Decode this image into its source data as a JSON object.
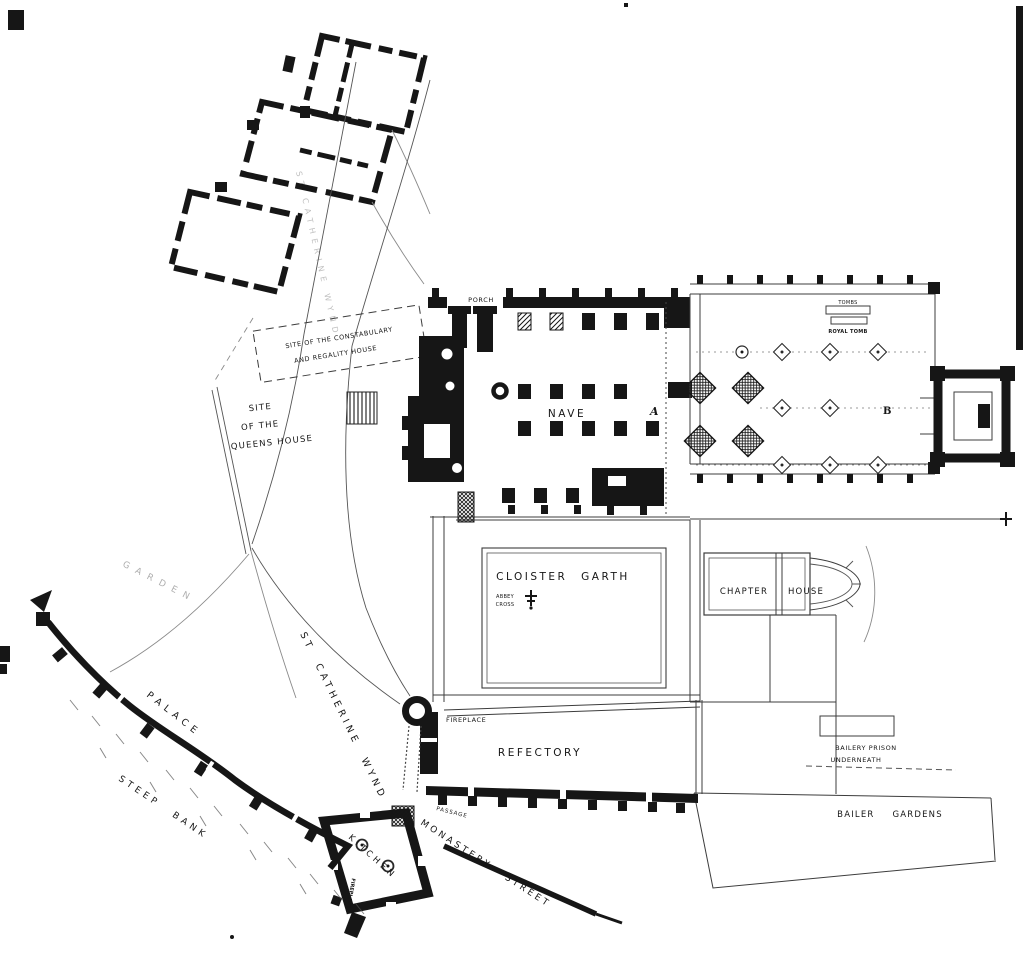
{
  "plan": {
    "colors": {
      "ink": "#161616",
      "paper": "#ffffff",
      "faint_line": "#8a8a8a"
    },
    "labels": {
      "porch": "PORCH",
      "constabulary_line1": "SITE OF THE CONSTABULARY",
      "constabulary_line2": "AND REGALITY HOUSE",
      "queens_line1": "SITE",
      "queens_line2": "OF THE",
      "queens_line3": "QUEENS HOUSE",
      "nave": "NAVE",
      "marker_a": "A",
      "marker_b": "B",
      "tombs": "TOMBS",
      "royal_tomb": "ROYAL TOMB",
      "cloister_garth": "CLOISTER GARTH",
      "abbey_cross_line1": "ABBEY",
      "abbey_cross_line2": "CROSS",
      "chapter": "CHAPTER",
      "house": "HOUSE",
      "fireplace_refectory": "FIREPLACE",
      "refectory": "REFECTORY",
      "bailery_prison_line1": "BAILERY PRISON",
      "bailery_prison_line2": "UNDERNEATH",
      "bailer_gardens": "BAILER GARDENS",
      "st_catherine_wynd": "ST CATHERINE WYND",
      "st_catherine_wynd_upper": "ST CATHERINE WYND",
      "monastery_street": "MONASTERY STREET",
      "kitchen": "KITCHEN",
      "passage": "PASSAGE",
      "fireplace_kitchen": "FIREPLACE",
      "palace": "PALACE",
      "steep_bank": "STEEP BANK",
      "garden": "GARDEN"
    }
  }
}
